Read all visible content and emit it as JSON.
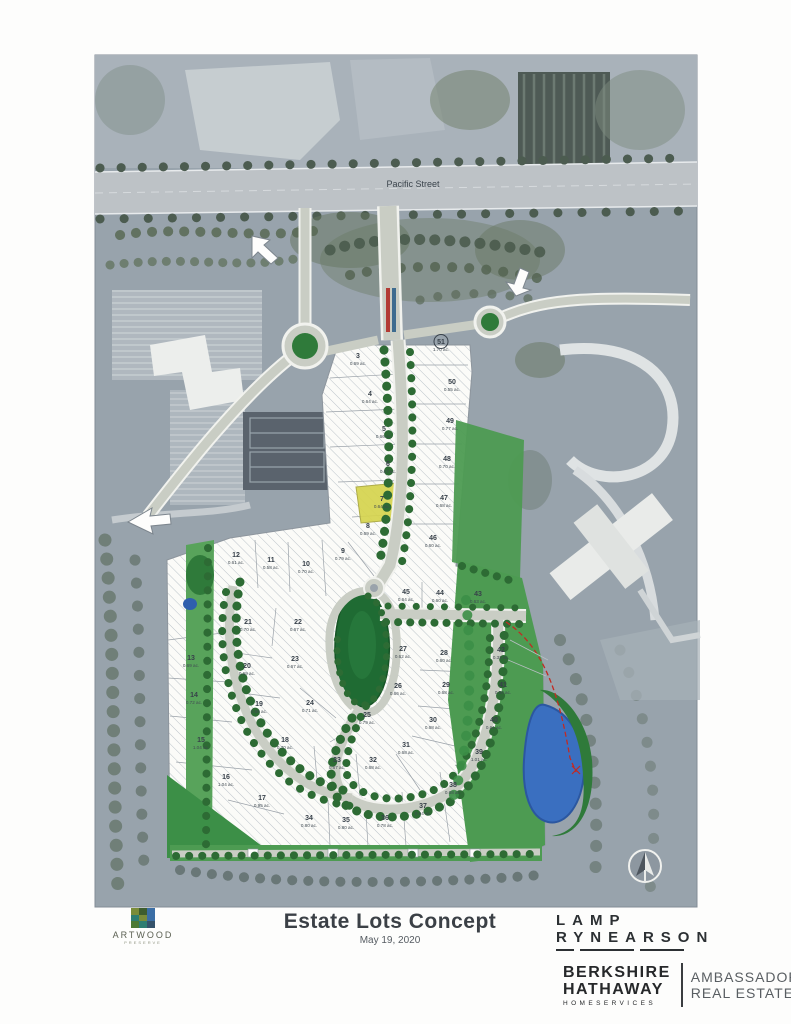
{
  "map": {
    "street_label": "Pacific Street",
    "title": "Estate Lots Concept",
    "date": "May 19, 2020",
    "compass_icon": "north-arrow",
    "highlight_color": "#d6d44e",
    "pond_color": "#3a6fc0",
    "green_color": "#4d9b52"
  },
  "lots": [
    {
      "number": "3",
      "acreage": "0.69 ac.",
      "x": 358,
      "y": 358
    },
    {
      "number": "4",
      "acreage": "0.64 ac.",
      "x": 370,
      "y": 396
    },
    {
      "number": "5",
      "acreage": "0.66 ac.",
      "x": 384,
      "y": 431
    },
    {
      "number": "6",
      "acreage": "0.67 ac.",
      "x": 388,
      "y": 466
    },
    {
      "number": "7",
      "acreage": "0.64 ac.",
      "x": 382,
      "y": 501,
      "highlight": true
    },
    {
      "number": "8",
      "acreage": "0.69 ac.",
      "x": 368,
      "y": 528
    },
    {
      "number": "9",
      "acreage": "0.79 ac.",
      "x": 343,
      "y": 553
    },
    {
      "number": "10",
      "acreage": "0.70 ac.",
      "x": 306,
      "y": 566
    },
    {
      "number": "11",
      "acreage": "0.58 ac.",
      "x": 271,
      "y": 562
    },
    {
      "number": "12",
      "acreage": "0.61 ac.",
      "x": 236,
      "y": 557
    },
    {
      "number": "13",
      "acreage": "0.69 ac.",
      "x": 191,
      "y": 660
    },
    {
      "number": "14",
      "acreage": "0.72 ac.",
      "x": 194,
      "y": 697
    },
    {
      "number": "15",
      "acreage": "1.04 ac.",
      "x": 201,
      "y": 742
    },
    {
      "number": "16",
      "acreage": "1.04 ac.",
      "x": 226,
      "y": 779
    },
    {
      "number": "17",
      "acreage": "0.95 ac.",
      "x": 262,
      "y": 800
    },
    {
      "number": "18",
      "acreage": "0.70 ac.",
      "x": 285,
      "y": 742
    },
    {
      "number": "19",
      "acreage": "0.69 ac.",
      "x": 259,
      "y": 706
    },
    {
      "number": "20",
      "acreage": "0.69 ac.",
      "x": 247,
      "y": 668
    },
    {
      "number": "21",
      "acreage": "0.70 ac.",
      "x": 248,
      "y": 624
    },
    {
      "number": "22",
      "acreage": "0.67 ac.",
      "x": 298,
      "y": 624
    },
    {
      "number": "23",
      "acreage": "0.67 ac.",
      "x": 295,
      "y": 661
    },
    {
      "number": "24",
      "acreage": "0.71 ac.",
      "x": 310,
      "y": 705
    },
    {
      "number": "25",
      "acreage": "0.79 ac.",
      "x": 367,
      "y": 717
    },
    {
      "number": "26",
      "acreage": "0.66 ac.",
      "x": 398,
      "y": 688
    },
    {
      "number": "27",
      "acreage": "0.62 ac.",
      "x": 403,
      "y": 651
    },
    {
      "number": "28",
      "acreage": "0.60 ac.",
      "x": 444,
      "y": 655
    },
    {
      "number": "29",
      "acreage": "0.68 ac.",
      "x": 446,
      "y": 687
    },
    {
      "number": "30",
      "acreage": "0.68 ac.",
      "x": 433,
      "y": 722
    },
    {
      "number": "31",
      "acreage": "0.68 ac.",
      "x": 406,
      "y": 747
    },
    {
      "number": "32",
      "acreage": "0.68 ac.",
      "x": 373,
      "y": 762
    },
    {
      "number": "33",
      "acreage": "0.67 ac.",
      "x": 337,
      "y": 762
    },
    {
      "number": "34",
      "acreage": "0.80 ac.",
      "x": 309,
      "y": 820
    },
    {
      "number": "35",
      "acreage": "0.80 ac.",
      "x": 346,
      "y": 822
    },
    {
      "number": "36",
      "acreage": "0.78 ac.",
      "x": 385,
      "y": 820
    },
    {
      "number": "37",
      "acreage": "0.94 ac.",
      "x": 423,
      "y": 808
    },
    {
      "number": "38",
      "acreage": "0.68 ac.",
      "x": 453,
      "y": 787
    },
    {
      "number": "39",
      "acreage": "1.01 ac.",
      "x": 479,
      "y": 754
    },
    {
      "number": "40",
      "acreage": "0.61 ac.",
      "x": 494,
      "y": 722
    },
    {
      "number": "41",
      "acreage": "0.50 ac.",
      "x": 503,
      "y": 687
    },
    {
      "number": "42",
      "acreage": "0.32 ac.",
      "x": 501,
      "y": 652
    },
    {
      "number": "43",
      "acreage": "0.63 ac.",
      "x": 478,
      "y": 596
    },
    {
      "number": "44",
      "acreage": "0.60 ac.",
      "x": 440,
      "y": 595
    },
    {
      "number": "45",
      "acreage": "0.64 ac.",
      "x": 406,
      "y": 594
    },
    {
      "number": "46",
      "acreage": "0.60 ac.",
      "x": 433,
      "y": 540
    },
    {
      "number": "47",
      "acreage": "0.68 ac.",
      "x": 444,
      "y": 500
    },
    {
      "number": "48",
      "acreage": "0.70 ac.",
      "x": 447,
      "y": 461
    },
    {
      "number": "49",
      "acreage": "0.77 ac.",
      "x": 450,
      "y": 423
    },
    {
      "number": "50",
      "acreage": "0.55 ac.",
      "x": 452,
      "y": 384
    },
    {
      "number": "51",
      "acreage": "1.70 ac.",
      "x": 441,
      "y": 344,
      "circled": true
    }
  ],
  "logos": {
    "artwood": {
      "name": "ARTWOOD",
      "tagline": "PRESERVE"
    },
    "lamp": {
      "line1": "LAMP",
      "line2": "RYNEARSON"
    },
    "berkshire": {
      "line1": "BERKSHIRE",
      "line2": "HATHAWAY",
      "line3": "HOMESERVICES",
      "right1": "AMBASSADOR",
      "right2": "REAL ESTATE"
    }
  }
}
